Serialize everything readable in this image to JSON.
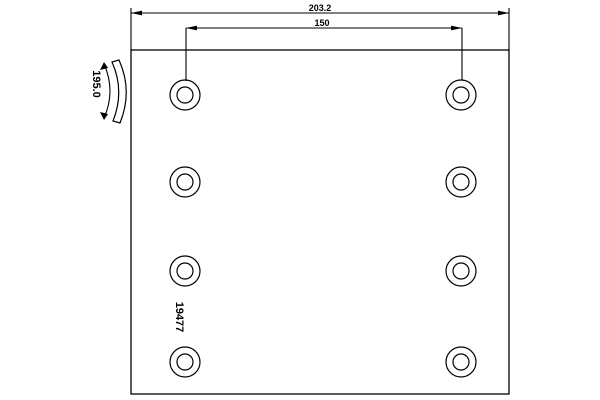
{
  "drawing": {
    "type": "brake-lining-technical-drawing",
    "part_number": "19477",
    "dimensions": {
      "overall_width": "203.2",
      "hole_spacing": "150",
      "curve_width": "195.0"
    },
    "holes": {
      "count": 8,
      "columns_x": [
        185,
        461
      ],
      "rows_y": [
        95,
        182,
        271,
        362
      ],
      "outer_radius": 15,
      "inner_radius": 8
    },
    "colors": {
      "line": "#000000",
      "background": "#ffffff"
    }
  }
}
